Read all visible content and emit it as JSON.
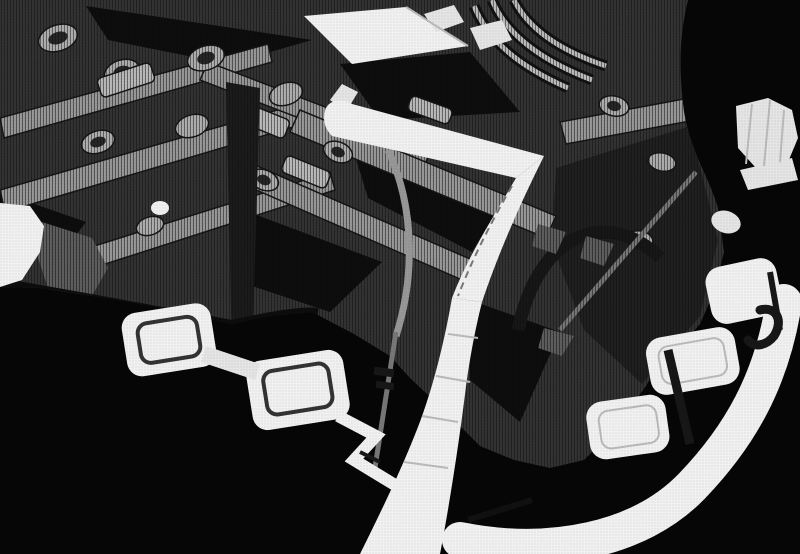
{
  "meta": {
    "description": "Grayscale halftone CAD rendering of a die-cast engine block with a bright runner, sprue column and overflow pads",
    "render_style": "monochrome 3D CAD, dithered print texture",
    "visible_text": ""
  },
  "colors": {
    "background": "#050505",
    "body": "#2f2f2f",
    "body_shade": "#1d1d1d",
    "shadow": "#0b0b0b",
    "beam": "#8f8f8f",
    "edge": "#141414",
    "boss": "#a7a7a7",
    "boss_core": "#232323",
    "cap": "#b3b3b3",
    "tube": "#b6b6b6",
    "tube_dark": "#101010",
    "post": "#191919",
    "gray_face": "#575757",
    "rib": "#6f6f6f",
    "runner": "#f0f0f0",
    "runner_dim": "#e3e3e3",
    "facet": "#b5b5b5",
    "pad_line": "#2f2f2f",
    "detail": "#151515"
  },
  "components": {
    "body": "engine-block-body",
    "sprue_bar": "upper-runner-bar",
    "sprue_arm": "descending-runner-arm",
    "sprue_column": "main-sprue-column",
    "overflow_left": "overflow-pads-left",
    "runner_curve": "curved-runner-band-right",
    "overflow_right": "overflow-pads-right",
    "top_plate": "bright-machined-plate",
    "knob": "faceted-fitting-right-edge"
  }
}
